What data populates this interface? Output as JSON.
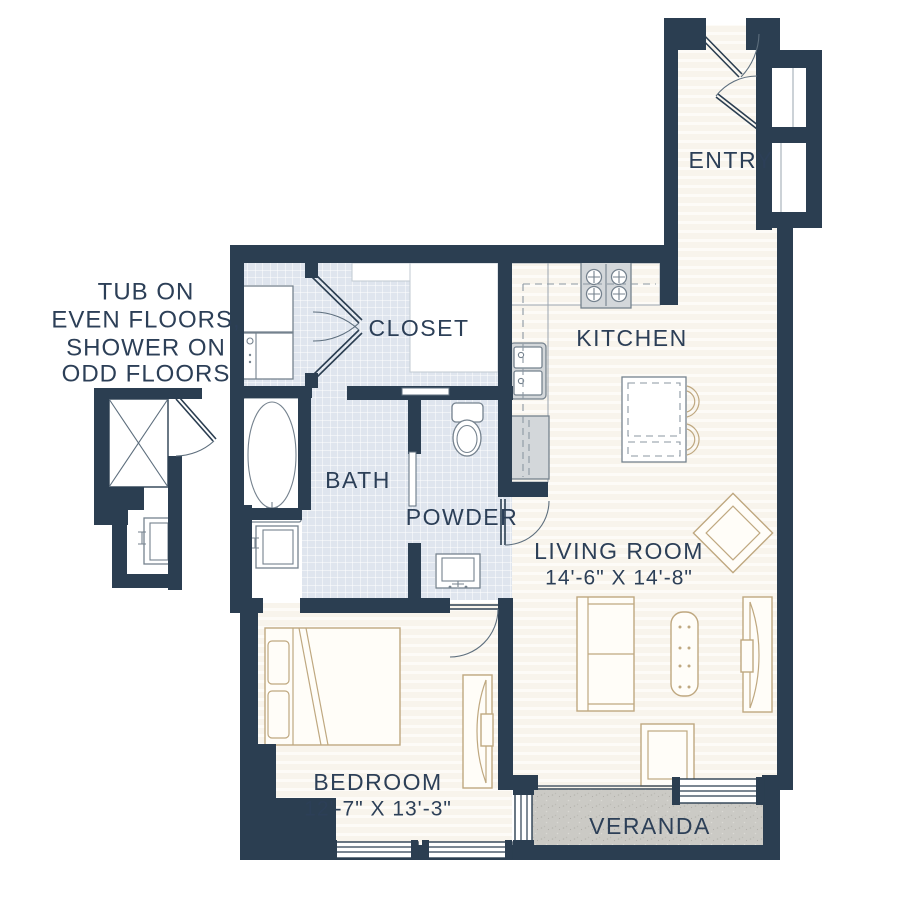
{
  "note": {
    "lines": [
      "TUB ON",
      "EVEN FLOORS,",
      "SHOWER ON",
      "ODD FLOORS"
    ]
  },
  "rooms": {
    "entry": {
      "label": "ENTRY"
    },
    "closet": {
      "label": "CLOSET"
    },
    "kitchen": {
      "label": "KITCHEN"
    },
    "bath": {
      "label": "BATH"
    },
    "powder": {
      "label": "POWDER"
    },
    "living": {
      "label": "LIVING ROOM",
      "dimensions": "14'-6\" X 14'-8\""
    },
    "bedroom": {
      "label": "BEDROOM",
      "dimensions": "12'-7\" X 13'-3\""
    },
    "veranda": {
      "label": "VERANDA"
    }
  },
  "palette": {
    "wall": "#2b3e51",
    "floor": "#f8f4ec",
    "floor_stripe": "#fdfbf7",
    "tile": "#dfe5ee",
    "veranda": "#cbcac5",
    "furniture_outline": "#bfa880",
    "fixture_outline": "#75828e",
    "fixture_fill": "#d3d7da",
    "label_text": "#2c3f57"
  }
}
